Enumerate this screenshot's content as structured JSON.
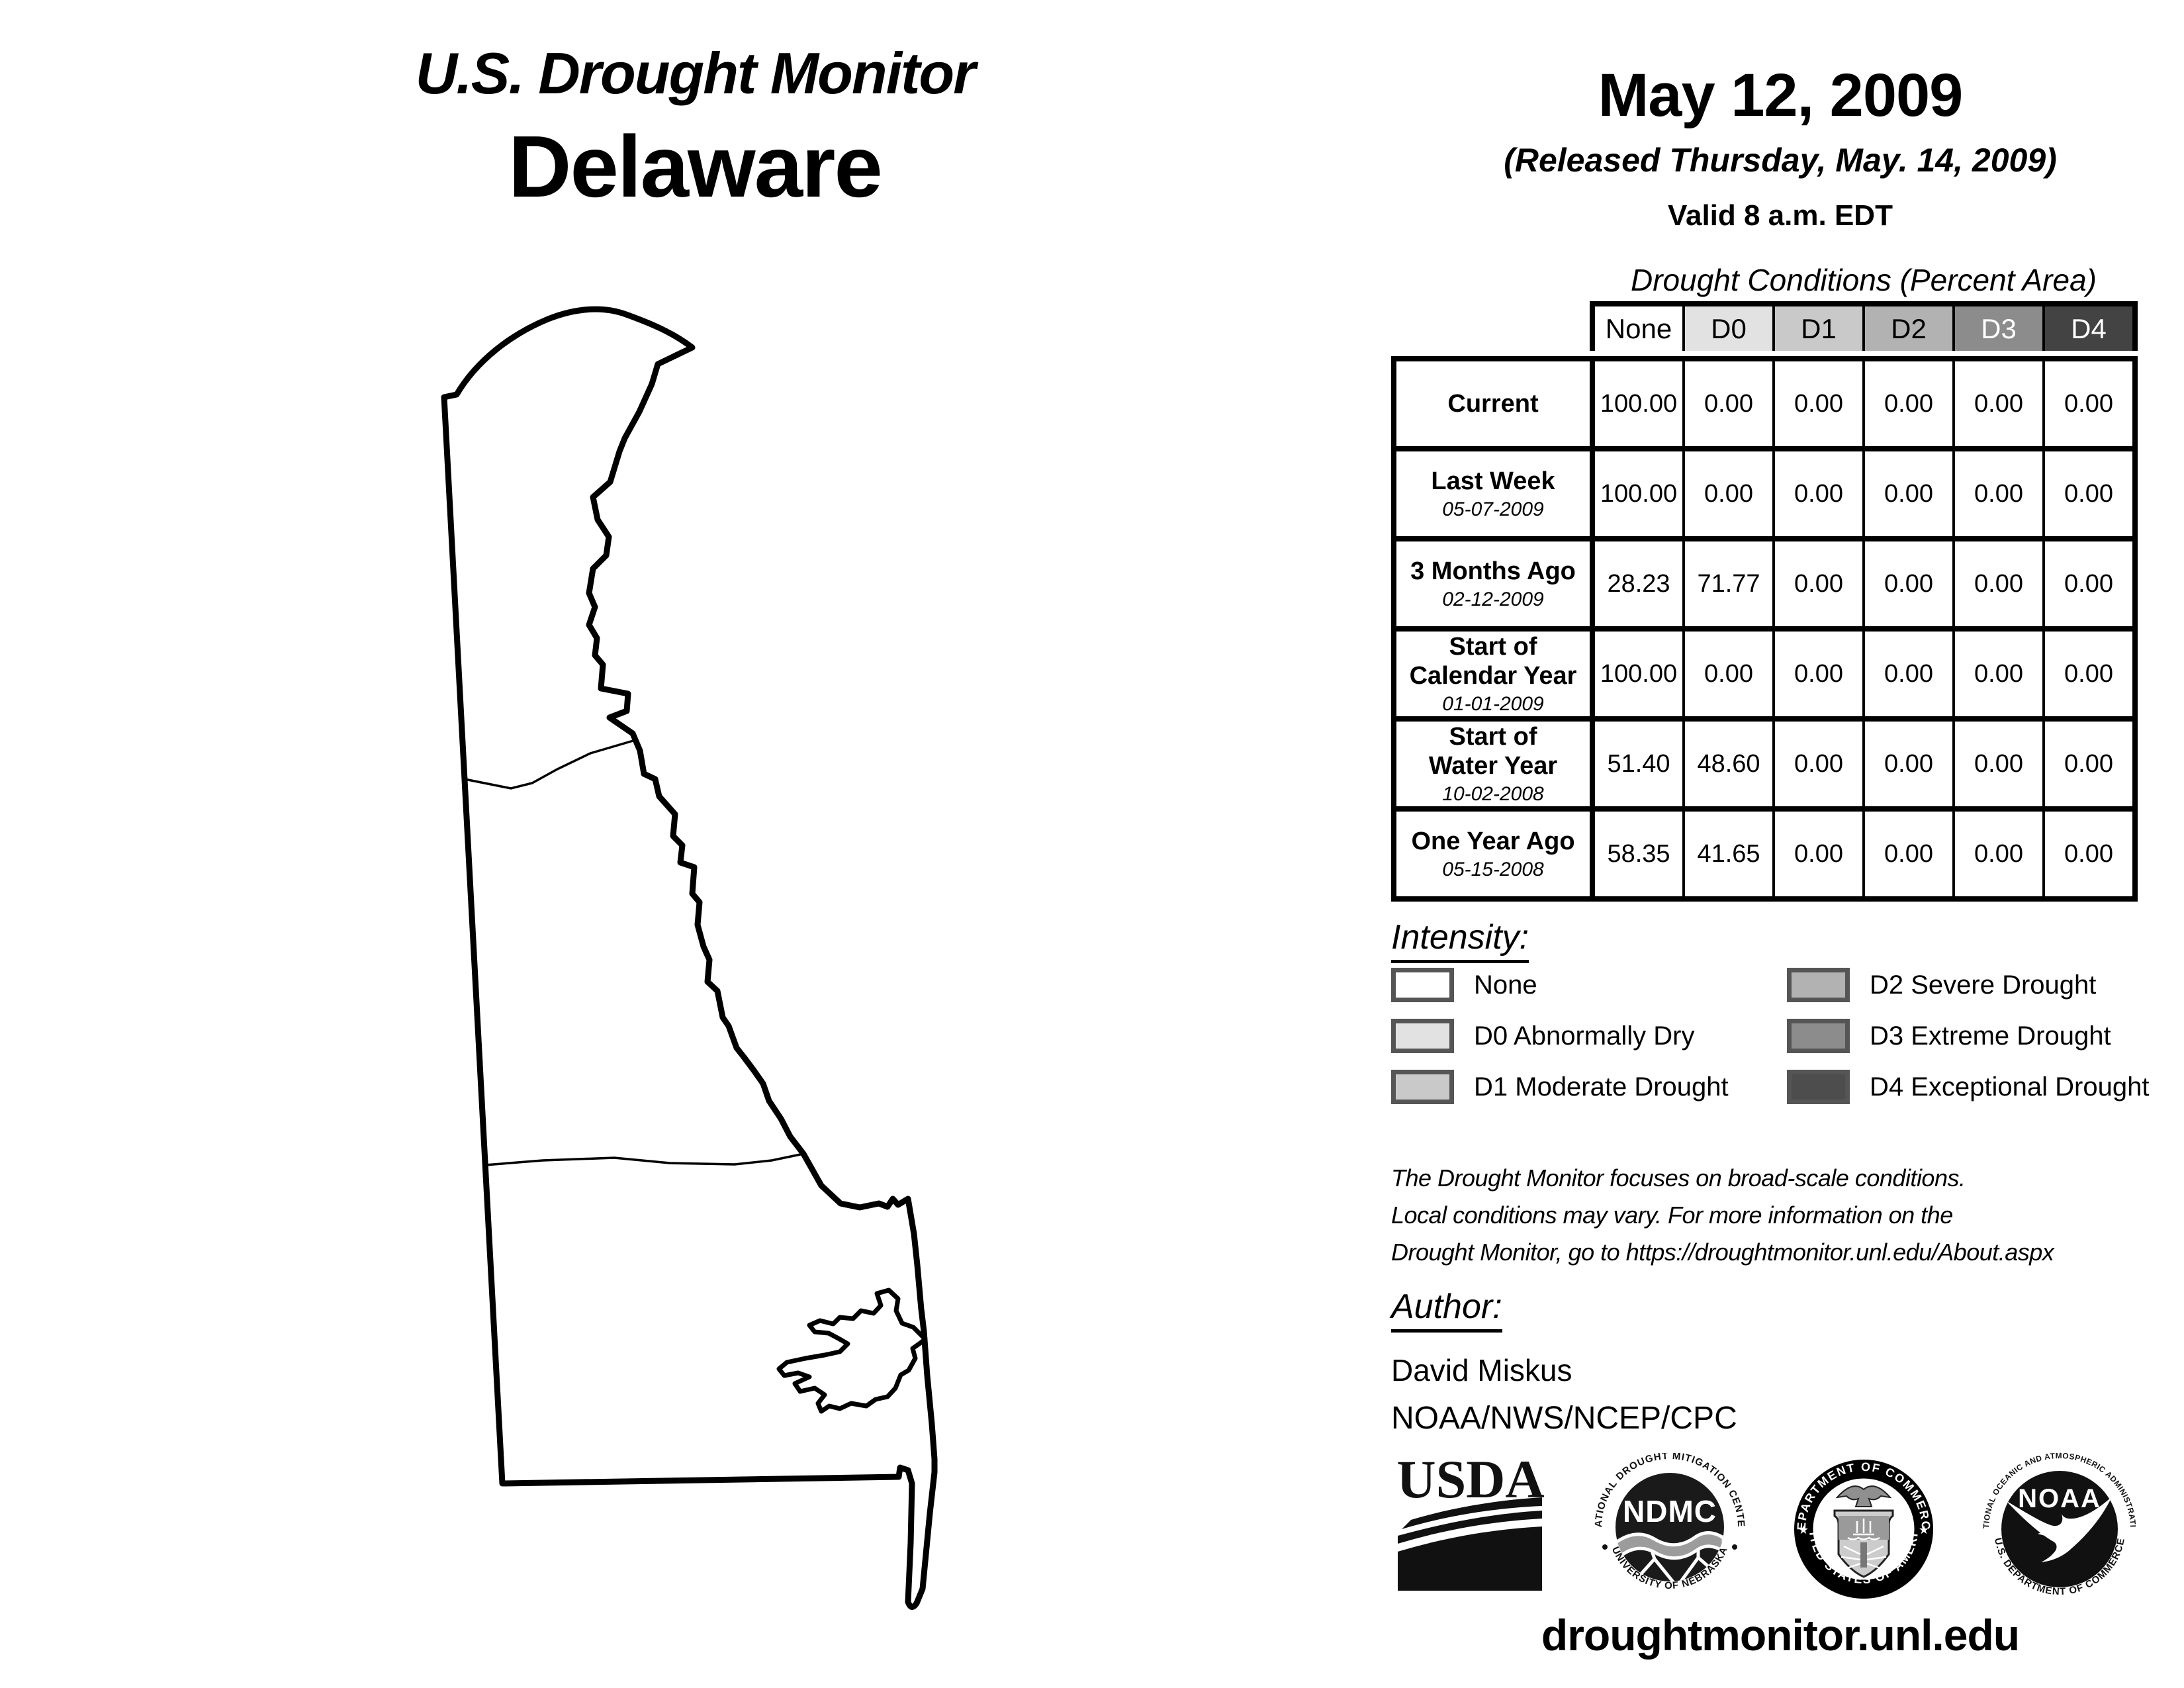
{
  "title": {
    "line1": "U.S. Drought Monitor",
    "line2": "Delaware"
  },
  "date_block": {
    "date": "May 12, 2009",
    "released": "(Released Thursday, May. 14, 2009)",
    "valid": "Valid 8 a.m. EDT"
  },
  "table": {
    "caption": "Drought Conditions (Percent Area)",
    "columns": [
      {
        "label": "None",
        "bg": "#ffffff",
        "fg": "#000000"
      },
      {
        "label": "D0",
        "bg": "#e2e2e2",
        "fg": "#000000"
      },
      {
        "label": "D1",
        "bg": "#c9c9c9",
        "fg": "#000000"
      },
      {
        "label": "D2",
        "bg": "#b2b2b2",
        "fg": "#000000"
      },
      {
        "label": "D3",
        "bg": "#8c8c8c",
        "fg": "#ffffff"
      },
      {
        "label": "D4",
        "bg": "#434343",
        "fg": "#ffffff"
      }
    ],
    "rows": [
      {
        "label": "Current",
        "date": "",
        "values": [
          "100.00",
          "0.00",
          "0.00",
          "0.00",
          "0.00",
          "0.00"
        ]
      },
      {
        "label": "Last Week",
        "date": "05-07-2009",
        "values": [
          "100.00",
          "0.00",
          "0.00",
          "0.00",
          "0.00",
          "0.00"
        ]
      },
      {
        "label": "3 Months Ago",
        "date": "02-12-2009",
        "values": [
          "28.23",
          "71.77",
          "0.00",
          "0.00",
          "0.00",
          "0.00"
        ]
      },
      {
        "label": "Start of\nCalendar Year",
        "date": "01-01-2009",
        "values": [
          "100.00",
          "0.00",
          "0.00",
          "0.00",
          "0.00",
          "0.00"
        ]
      },
      {
        "label": "Start of\nWater Year",
        "date": "10-02-2008",
        "values": [
          "51.40",
          "48.60",
          "0.00",
          "0.00",
          "0.00",
          "0.00"
        ]
      },
      {
        "label": "One Year Ago",
        "date": "05-15-2008",
        "values": [
          "58.35",
          "41.65",
          "0.00",
          "0.00",
          "0.00",
          "0.00"
        ]
      }
    ]
  },
  "legend": {
    "heading": "Intensity:",
    "left": [
      {
        "label": "None",
        "color": "#ffffff"
      },
      {
        "label": "D0 Abnormally Dry",
        "color": "#e2e2e2"
      },
      {
        "label": "D1 Moderate Drought",
        "color": "#c9c9c9"
      }
    ],
    "right": [
      {
        "label": "D2 Severe Drought",
        "color": "#b2b2b2"
      },
      {
        "label": "D3 Extreme Drought",
        "color": "#8c8c8c"
      },
      {
        "label": "D4 Exceptional Drought",
        "color": "#4d4d4d"
      }
    ]
  },
  "disclaimer": {
    "line1": "The Drought Monitor focuses on broad-scale conditions.",
    "line2": "Local conditions may vary. For more information on the",
    "line3": "Drought Monitor, go to https://droughtmonitor.unl.edu/About.aspx"
  },
  "author": {
    "heading": "Author:",
    "name": "David Miskus",
    "org": "NOAA/NWS/NCEP/CPC"
  },
  "footer": {
    "url": "droughtmonitor.unl.edu"
  },
  "logos": {
    "usda": {
      "text": "USDA"
    },
    "ndmc": {
      "center": "NDMC",
      "arc_top": "NATIONAL DROUGHT MITIGATION CENTER",
      "arc_bottom": "UNIVERSITY OF NEBRASKA"
    },
    "commerce": {
      "arc_top": "DEPARTMENT OF COMMERCE",
      "arc_bottom": "UNITED STATES OF AMERICA"
    },
    "noaa": {
      "center": "NOAA",
      "arc_top": "NATIONAL OCEANIC AND ATMOSPHERIC ADMINISTRATION",
      "arc_bottom": "U.S. DEPARTMENT OF COMMERCE"
    }
  },
  "map": {
    "label": "Delaware state outline with county boundaries"
  }
}
